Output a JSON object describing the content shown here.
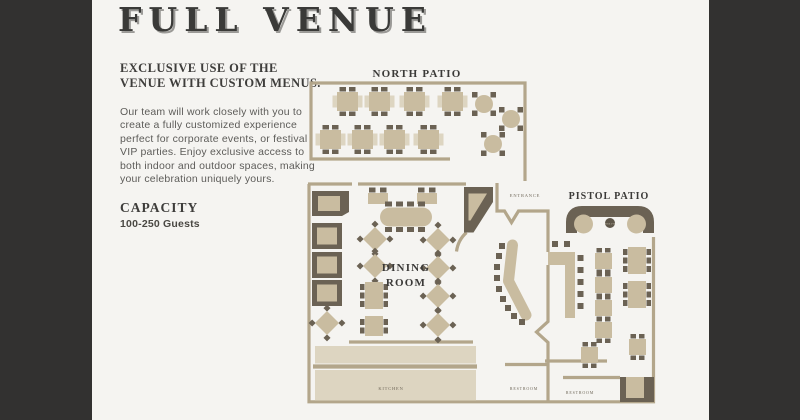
{
  "page": {
    "title": "FULL VENUE",
    "frame_color": "#323130",
    "content_bg": "#f5f4f1"
  },
  "info": {
    "heading": "EXCLUSIVE USE OF THE\nVENUE WITH CUSTOM MENUS.",
    "body": "Our team will work closely with you to\ncreate a fully customized experience\nperfect for corporate events, or festival\nVIP parties. Enjoy exclusive access to\nboth indoor and outdoor spaces, making\nyour celebration uniquely yours.",
    "capacity_label": "CAPACITY",
    "capacity_value": "100-250 Guests"
  },
  "floorplan": {
    "labels": {
      "north_patio": "NORTH PATIO",
      "pistol_patio": "PISTOL PATIO",
      "dining_line1": "DINING",
      "dining_line2": "ROOM",
      "entrance": "ENTRANCE",
      "kitchen": "KITCHEN",
      "restroom_left": "RESTROOM",
      "restroom_right": "RESTROOM",
      "fire_pit": "FIRE PIT"
    },
    "colors": {
      "wall": "#b3a68b",
      "table": "#c9bca0",
      "dark_furniture": "#6b6254",
      "counter": "#ddd5c1",
      "label_text": "#3b3a38",
      "small_label_text": "#6f6759"
    }
  }
}
